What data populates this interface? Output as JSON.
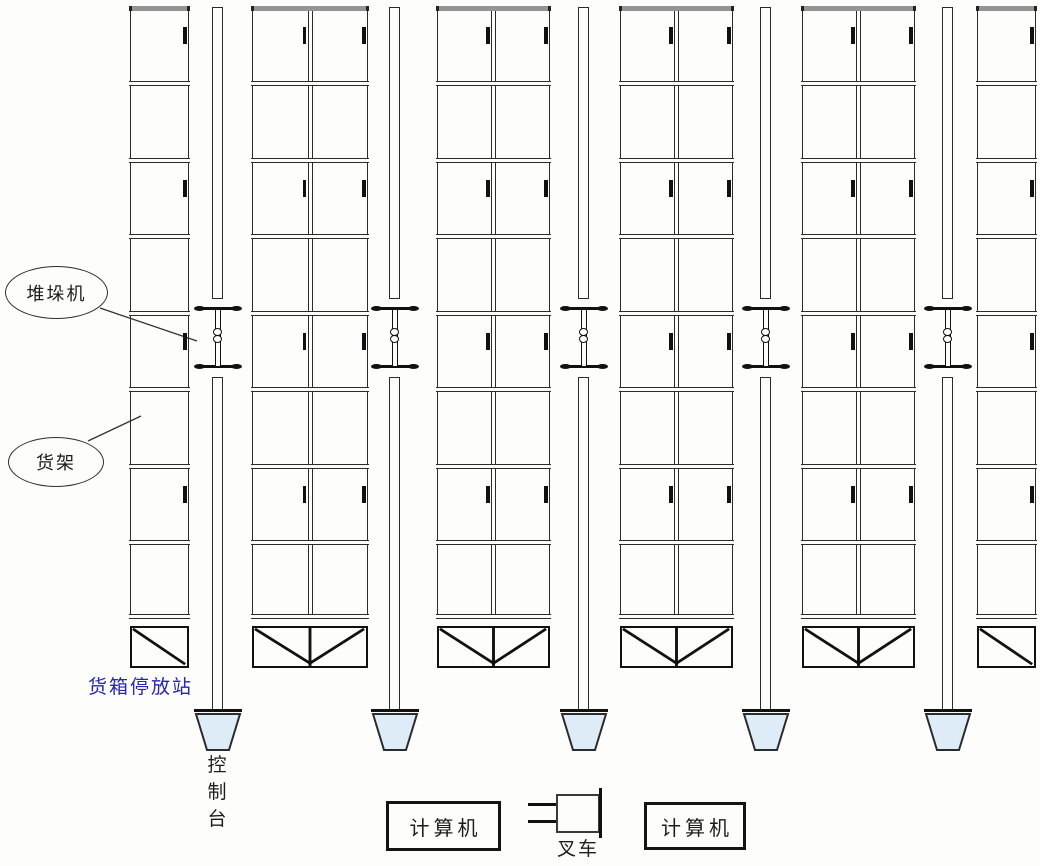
{
  "labels": {
    "stacker_crane": "堆垛机",
    "rack": "货架",
    "container_station": "货箱停放站",
    "console": [
      "控",
      "制",
      "台"
    ],
    "computer_left": "计算机",
    "computer_right": "计算机",
    "forklift": "叉车"
  },
  "colors": {
    "background": "#fdfdfc",
    "line": "#2b2b2b",
    "rack_cap": "#949494",
    "station_label": "#2626b2",
    "console_fill": "#ddecf7"
  },
  "structure": {
    "rows_per_rack": 8,
    "racks": [
      {
        "x": 130,
        "w": 59,
        "cols": 1
      },
      {
        "x": 252,
        "w": 116,
        "cols": 2
      },
      {
        "x": 437,
        "w": 113,
        "cols": 2
      },
      {
        "x": 620,
        "w": 113,
        "cols": 2
      },
      {
        "x": 802,
        "w": 113,
        "cols": 2
      },
      {
        "x": 977,
        "w": 59,
        "cols": 1
      }
    ],
    "aisles": [
      {
        "x": 212
      },
      {
        "x": 389
      },
      {
        "x": 578
      },
      {
        "x": 760
      },
      {
        "x": 942
      }
    ]
  }
}
